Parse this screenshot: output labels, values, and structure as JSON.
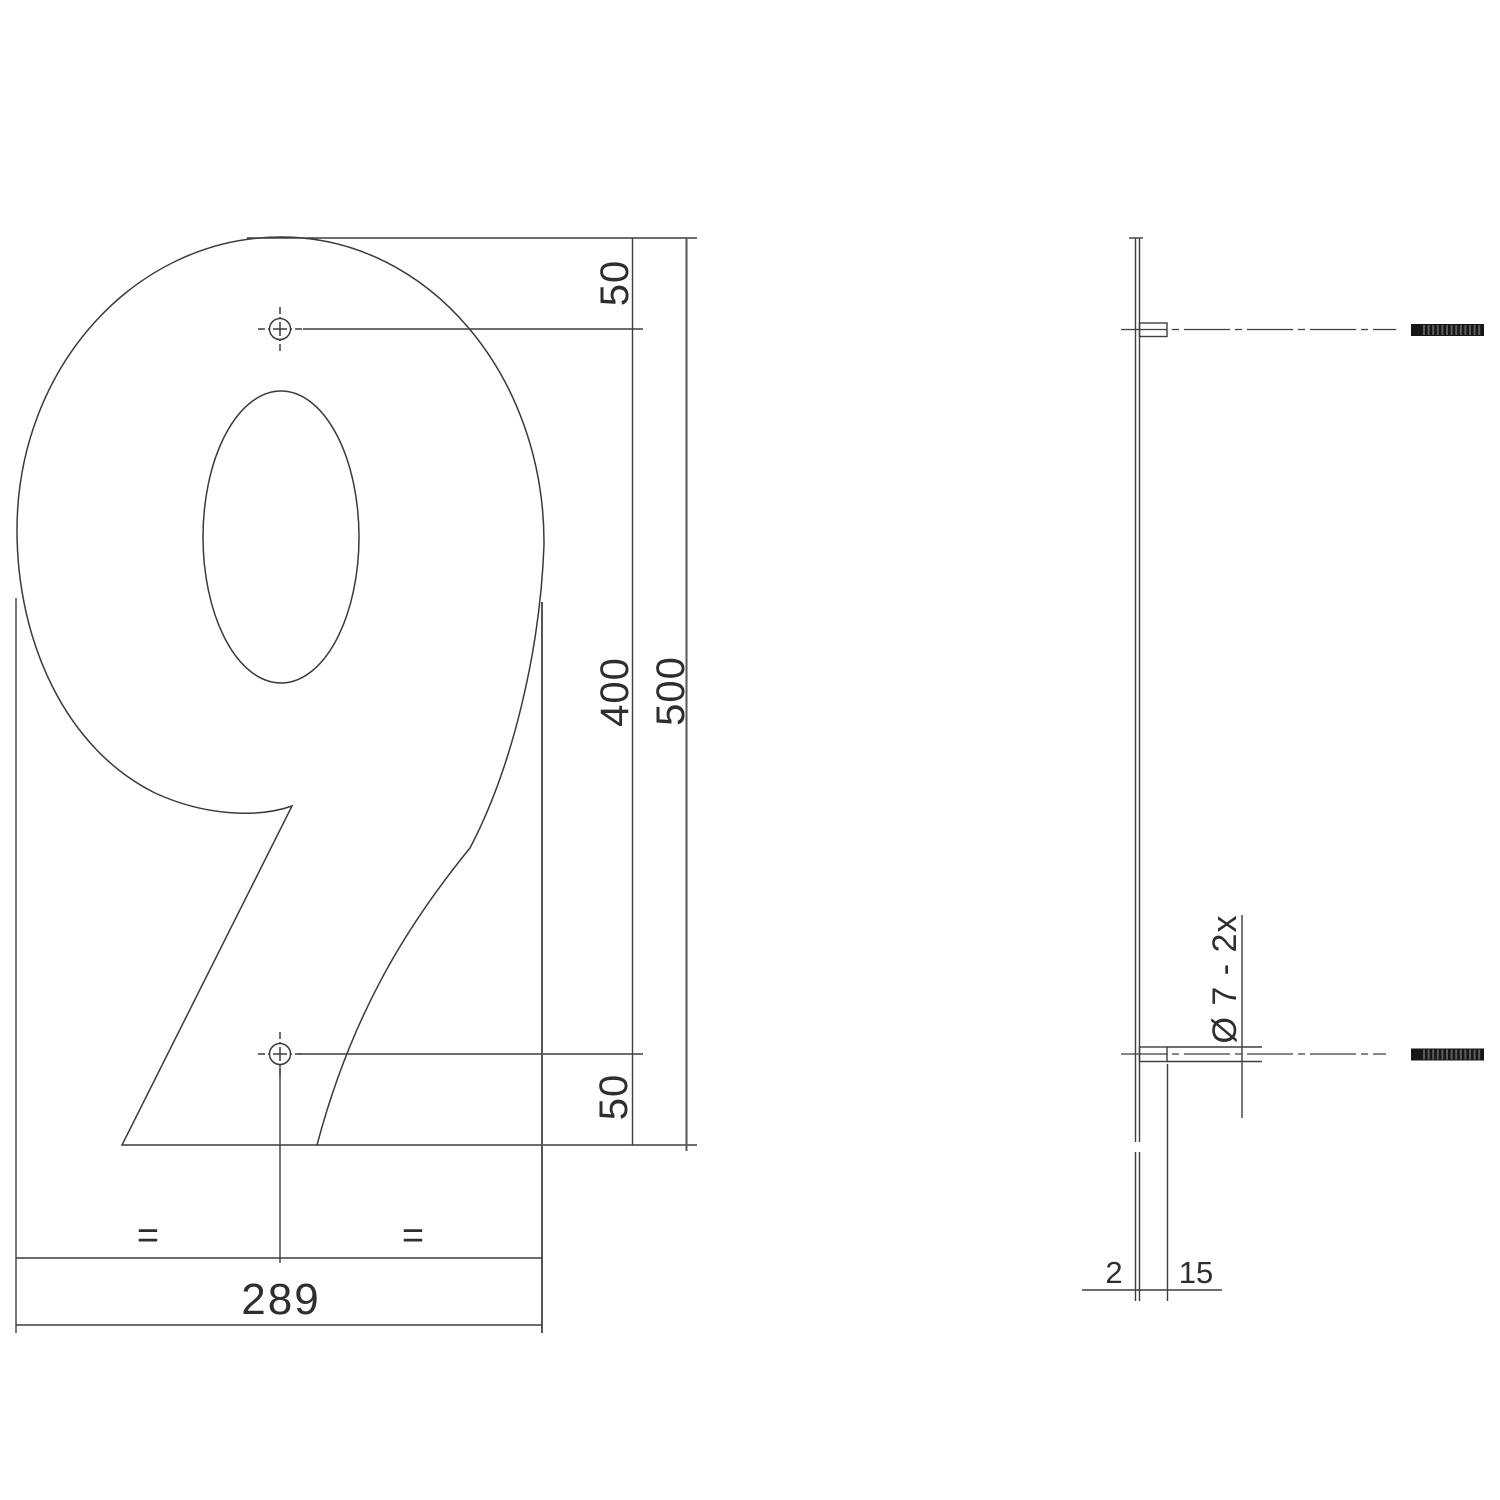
{
  "front_view": {
    "digit": "9",
    "dim_top_offset": "50",
    "dim_hole_spacing": "400",
    "dim_total_height": "500",
    "dim_bottom_offset": "50",
    "equal_mark_left": "=",
    "equal_mark_right": "=",
    "dim_width": "289"
  },
  "side_view": {
    "dim_thickness": "2",
    "dim_standoff_length": "15",
    "dim_hole": "Ø 7 - 2x"
  },
  "colors": {
    "background": "#ffffff",
    "line": "#3e3e3e",
    "text": "#2e2e2e",
    "screw": "#161616"
  }
}
